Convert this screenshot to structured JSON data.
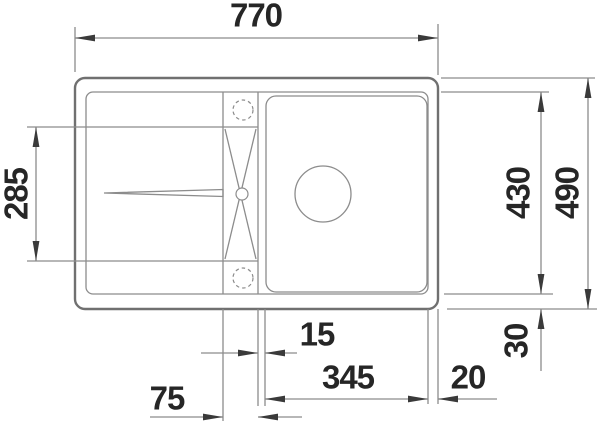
{
  "drawing": {
    "type": "technical-dimension-drawing",
    "subject": "inset-sink-top-view",
    "dimensions": {
      "overall_width": "770",
      "overall_depth": "490",
      "inner_depth": "430",
      "drainboard_depth": "285",
      "rear_rim": "30",
      "divider_width": "15",
      "bowl_width": "345",
      "right_rim": "20",
      "drain_section_width": "75"
    },
    "colors": {
      "background": "#ffffff",
      "line": "#8c8c8c",
      "outline": "#707070",
      "text": "#262626",
      "arrow": "#3a3a3a"
    }
  }
}
